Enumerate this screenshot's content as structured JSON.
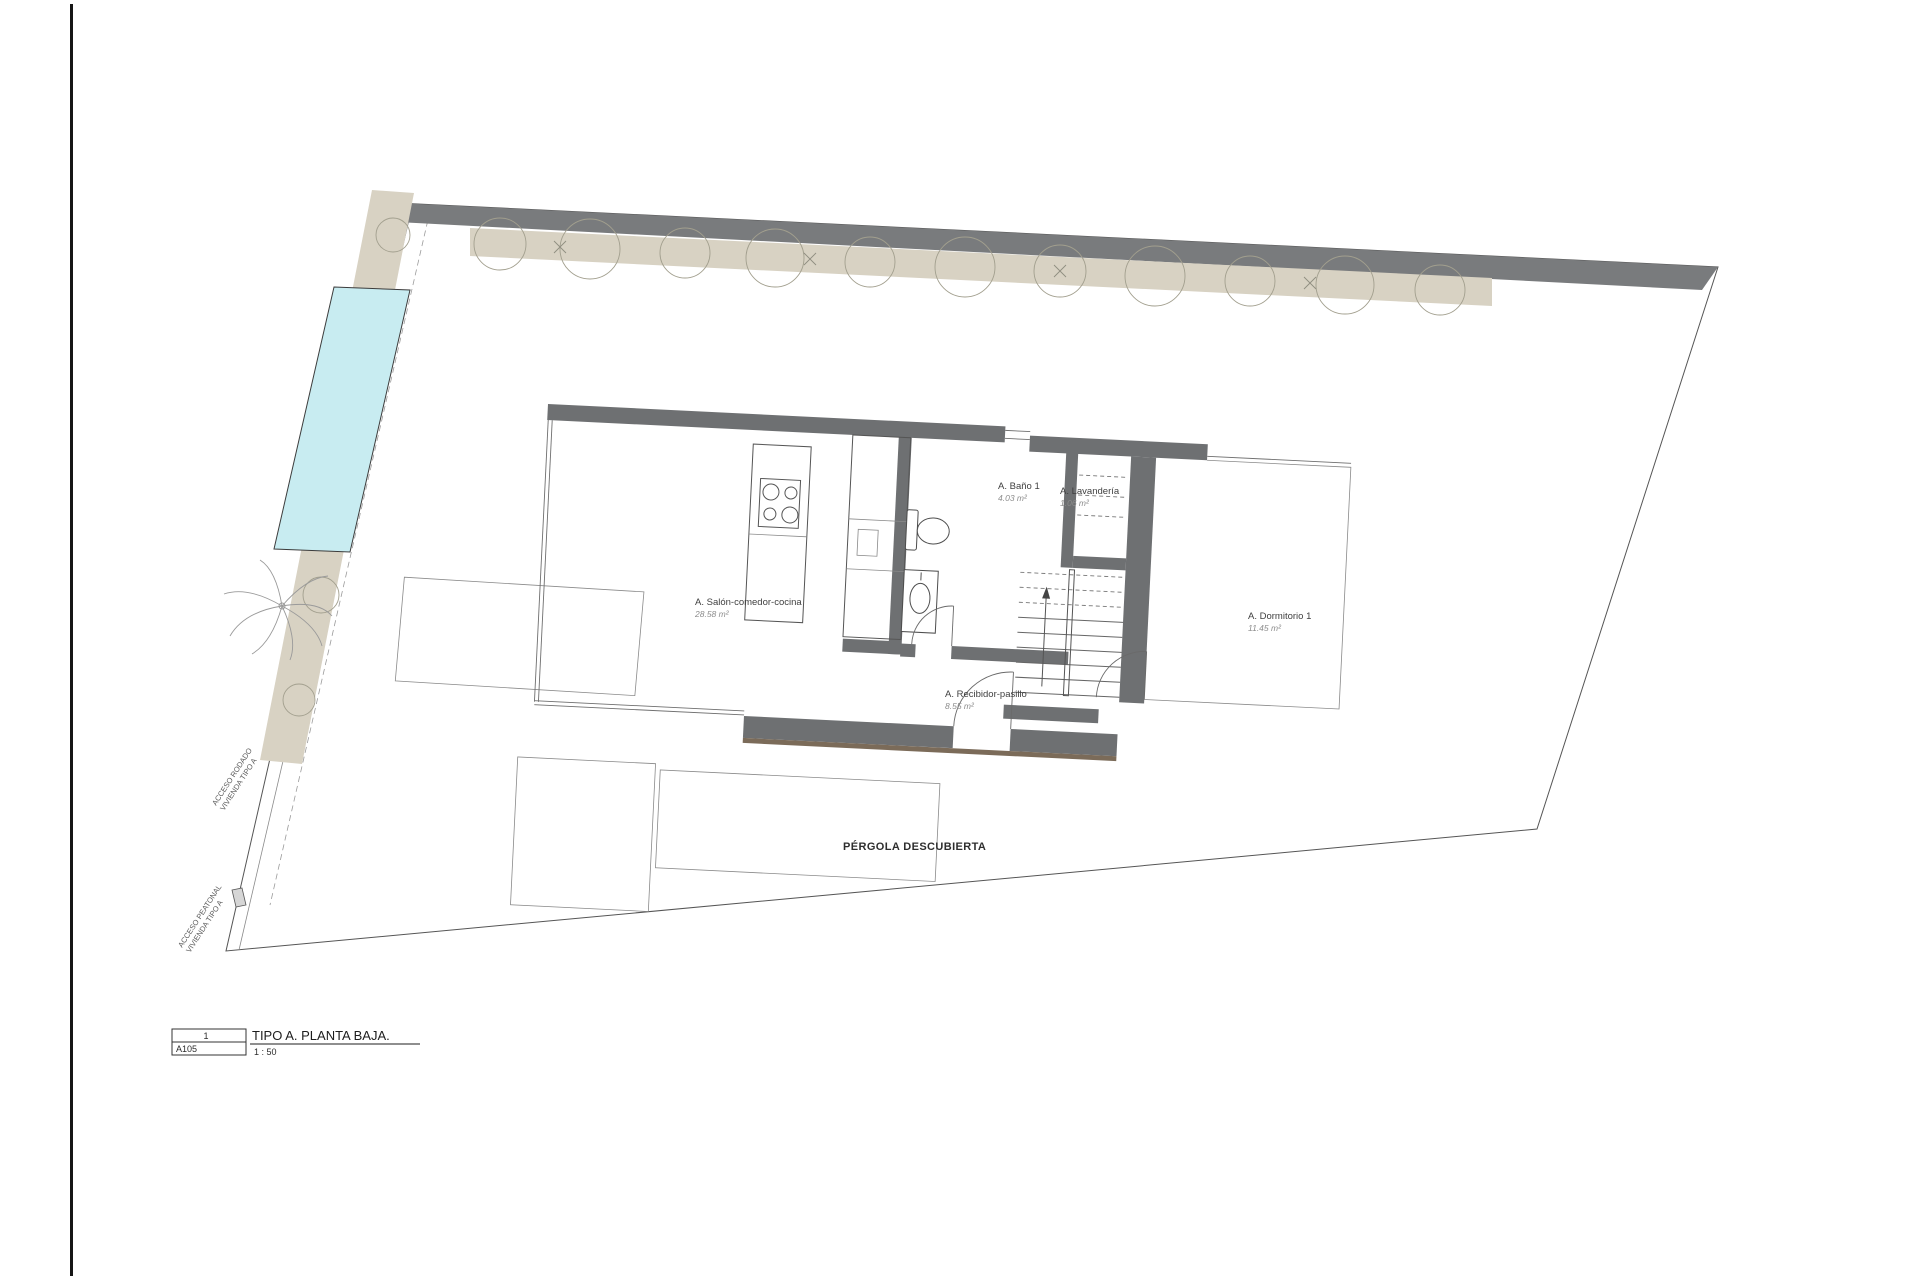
{
  "sheet": {
    "title_block": {
      "number": "1",
      "code": "A105",
      "title": "TIPO A. PLANTA BAJA.",
      "scale": "1 : 50"
    }
  },
  "plan": {
    "rooms": [
      {
        "id": "salon",
        "name": "A. Salón-comedor-cocina",
        "area": "28.58 m²"
      },
      {
        "id": "bano",
        "name": "A. Baño 1",
        "area": "4.03 m²"
      },
      {
        "id": "lavanderia",
        "name": "A. Lavandería",
        "area": "1.06 m²"
      },
      {
        "id": "dormitorio",
        "name": "A. Dormitorio 1",
        "area": "11.45 m²"
      },
      {
        "id": "recibidor",
        "name": "A. Recibidor-pasillo",
        "area": "8.55 m²"
      }
    ],
    "outdoor": {
      "pergola_label": "PÉRGOLA DESCUBIERTA"
    },
    "access": [
      {
        "id": "rodado",
        "line1": "ACCESO RODADO",
        "line2": "VIVIENDA TIPO A"
      },
      {
        "id": "peatonal",
        "line1": "ACCESO PEATONAL",
        "line2": "VIVIENDA TIPO A"
      }
    ],
    "colors": {
      "wall": "#6e7072",
      "perimeter_wall": "#797b7d",
      "hedge": "#d8d2c3",
      "pool": "#c8ecf1",
      "floor_accent": "#7b6b59"
    }
  }
}
